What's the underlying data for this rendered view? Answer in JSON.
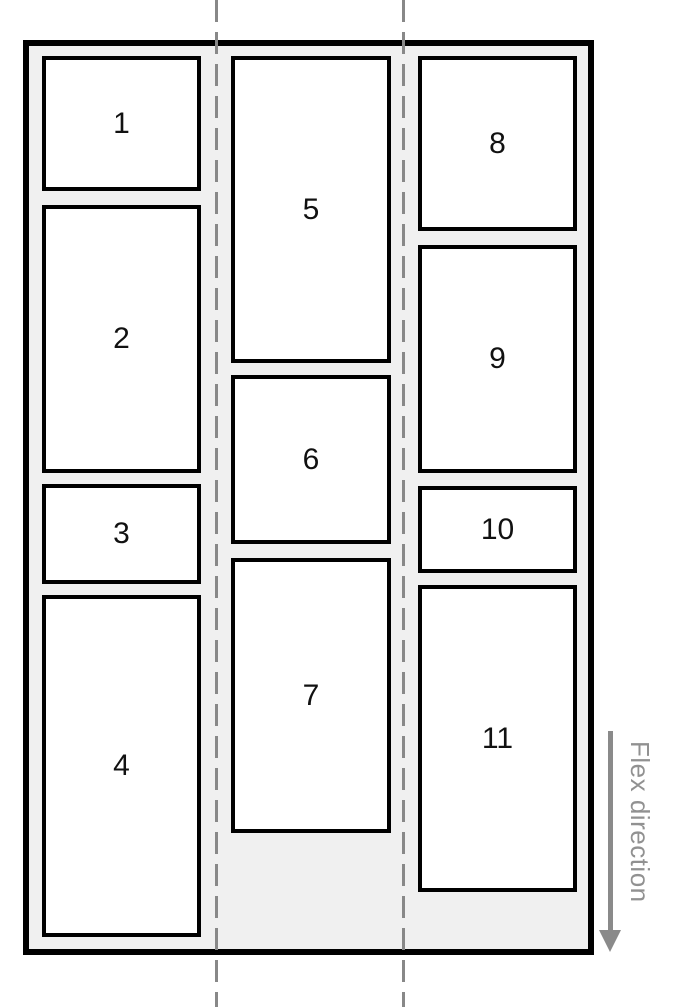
{
  "diagram": {
    "type": "flexbox-column-wrap-illustration",
    "columns": [
      {
        "items": [
          {
            "label": "1"
          },
          {
            "label": "2"
          },
          {
            "label": "3"
          },
          {
            "label": "4"
          }
        ]
      },
      {
        "items": [
          {
            "label": "5"
          },
          {
            "label": "6"
          },
          {
            "label": "7"
          }
        ]
      },
      {
        "items": [
          {
            "label": "8"
          },
          {
            "label": "9"
          },
          {
            "label": "10"
          },
          {
            "label": "11"
          }
        ]
      }
    ],
    "annotation": {
      "label": "Flex direction",
      "arrow_direction": "down"
    },
    "colors": {
      "container_fill": "#f0f0f0",
      "container_border": "#000000",
      "item_fill": "#ffffff",
      "item_border": "#000000",
      "item_text": "#111111",
      "guide": "#888888",
      "annotation": "#919191"
    }
  }
}
